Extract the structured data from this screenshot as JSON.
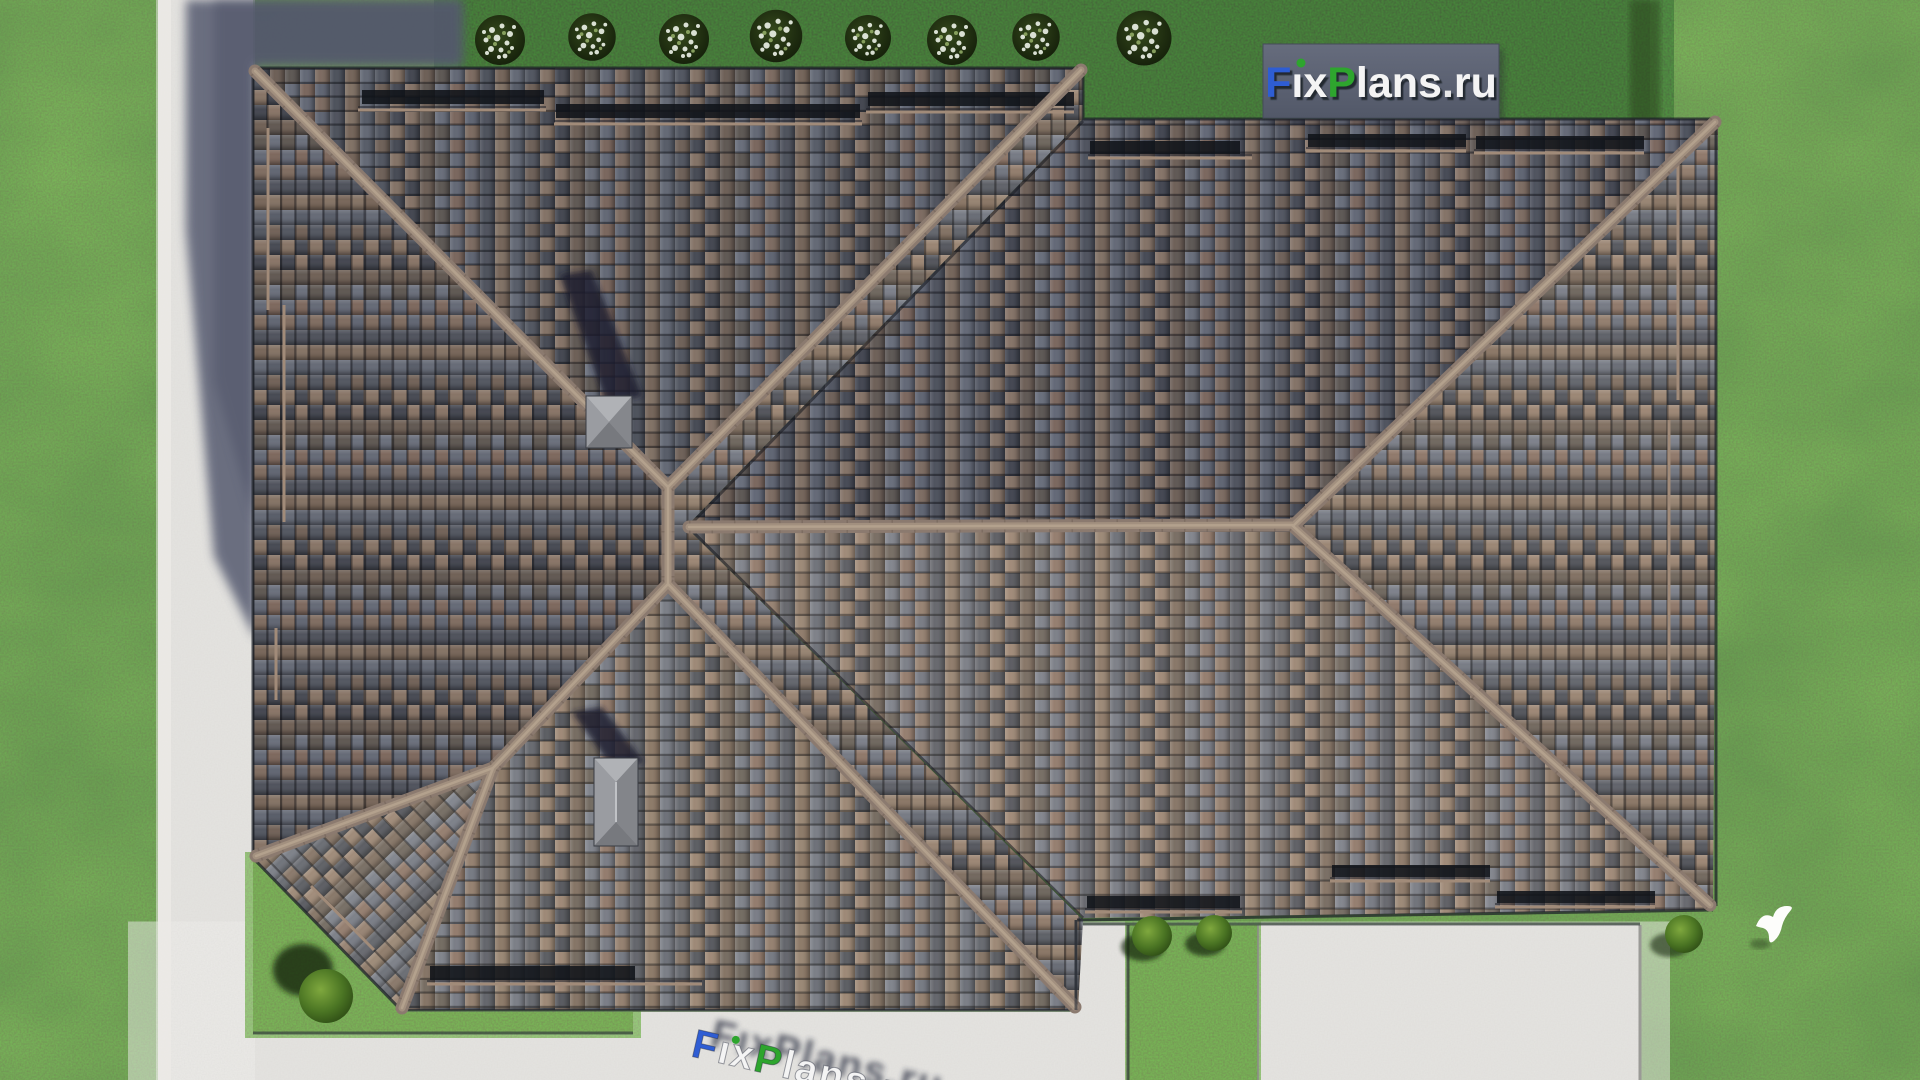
{
  "scene": {
    "type": "aerial-architectural-render",
    "subject": "Top-down aerial view of a house with a complex brown-gray tiled hip roof, two chimneys, surrounded by lawn, concrete paths, a patio, a dark hedge with white flowering shrubs, garden bushes and a white bird on the grass"
  },
  "watermark": {
    "text": "FixPlans.ru",
    "box_color": "#5d6374",
    "i_dot_color": "#2da52d",
    "segments": [
      {
        "t": "F",
        "c": "#2f5dd3"
      },
      {
        "t": "ı",
        "c": "#f4f4f4"
      },
      {
        "t": "x",
        "c": "#f4f4f4"
      },
      {
        "t": "P",
        "c": "#2da52d"
      },
      {
        "t": "lans",
        "c": "#f4f4f4"
      },
      {
        "t": ".",
        "c": "#e8e8e8"
      },
      {
        "t": "ru",
        "c": "#f4f4f4"
      }
    ]
  },
  "ground_watermark": {
    "text": "FixPlans.ru"
  },
  "palette": {
    "grass": "#52781f",
    "hedge": "#1c2a10",
    "path_concrete": "#d8d7d3",
    "building_shadow": "#5a5e73",
    "roof_tile_brown": "#8a7264",
    "roof_tile_gray": "#6b707c",
    "roof_tile_dark": "#585b64",
    "ridge_cap": "#a2907f",
    "chimney_cap": "#a3a5aa"
  },
  "landscape": {
    "flowering_shrub_count": 8,
    "garden_bush_count": 4,
    "bird": "white bird on lawn, lower right"
  }
}
